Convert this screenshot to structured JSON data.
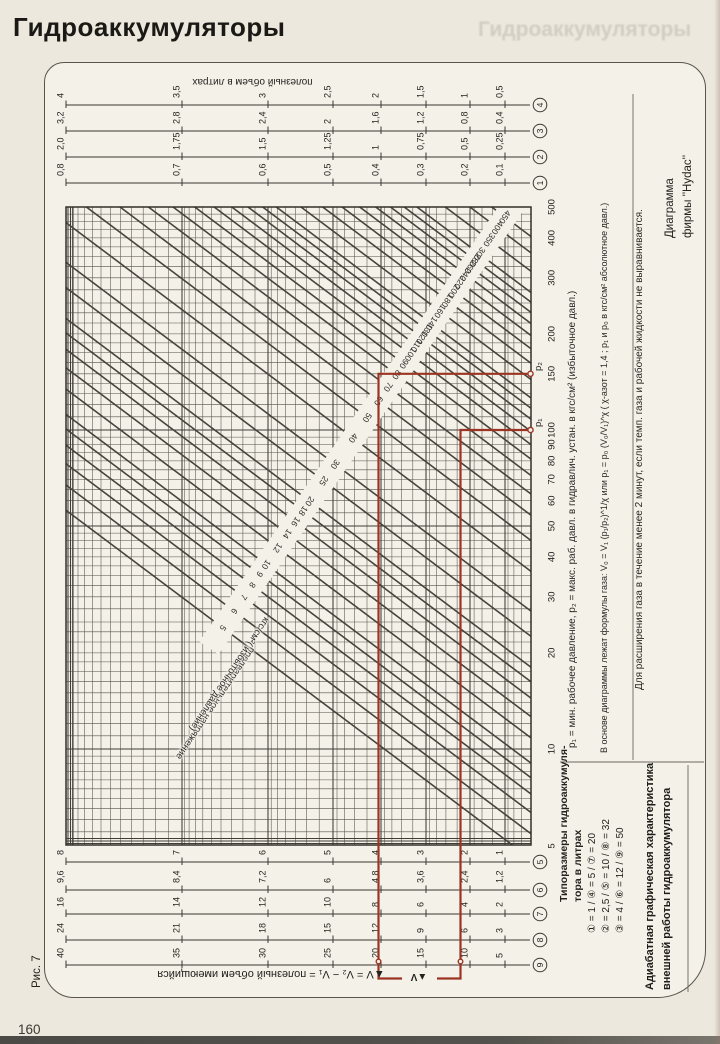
{
  "page": {
    "title": "Гидроаккумуляторы",
    "ghost_title": "Гидроаккумуляторы",
    "page_number": "160",
    "figure_label": "Рис. 7"
  },
  "diagram": {
    "credit": {
      "line1": "Диаграмма",
      "line2": "фирмы ''Hydac''"
    },
    "top_caption": "полезный объем в литрах",
    "bottom_caption": "▲V = V₂ − V₁ = полезный объем имеющийся",
    "delta_v_label": "▲V",
    "band_caption": {
      "line1": "предварительное напряжение",
      "line2": "кгс/см²( избыточное давление)"
    },
    "notes": [
      "p₁ = мин. рабочее давление,  p₂ = макс. раб. давл. в гидравлич. устан. в кгс/см²  (избыточное давл.)",
      "В основе диаграммы лежат формулы газа:  V₀ = V₁ (p₁/p₂)^1/χ  или  p₁ = p₀ (V₀/V₁)^χ   ( χ-азот = 1,4 ;  p₁ и p₀ в кгс/см² абсолютное давл.)",
      "Для расширения газа в течение менее 2 минут, если темп. газа и рабочей жидкости не выравнивается."
    ],
    "sizes": {
      "title_line1": "Типоразмеры гидроаккумуля-",
      "title_line2": "тора в литрах",
      "rows": [
        "① = 1   / ④ = 5  / ⑦ = 20",
        "② = 2,5 / ⑤ = 10 / ⑧ = 32",
        "③ = 4   / ⑥ = 12 / ⑨ = 50"
      ]
    },
    "caption_title": {
      "line1": "Адиабатная графическая характеристика",
      "line2": "внешней работы гидроаккумулятора"
    },
    "red_overlay": {
      "p1_label": "p₁",
      "p2_label": "p₂",
      "p1_value": 100,
      "p2_value": 150,
      "color": "#9c3424"
    },
    "pressure_axis_values": [
      500,
      400,
      300,
      200,
      150,
      100,
      90,
      80,
      70,
      60,
      50,
      40,
      30,
      20,
      10,
      5
    ],
    "precharge_values": [
      5,
      6,
      7,
      8,
      9,
      10,
      12,
      14,
      16,
      18,
      20,
      25,
      30,
      40,
      50,
      60,
      70,
      80,
      90,
      100,
      110,
      120,
      130,
      140,
      160,
      180,
      200,
      220,
      240,
      260,
      280,
      300,
      350,
      400,
      450
    ],
    "top_scales": [
      {
        "id": "4",
        "labels": [
          "4",
          "3,5",
          "3",
          "2,5",
          "2",
          "1,5",
          "1",
          "0,5"
        ]
      },
      {
        "id": "3",
        "labels": [
          "3,2",
          "2,8",
          "2,4",
          "2",
          "1,6",
          "1,2",
          "0,8",
          "0,4"
        ]
      },
      {
        "id": "2",
        "labels": [
          "2,0",
          "1,75",
          "1,5",
          "1,25",
          "1",
          "0,75",
          "0,5",
          "0,25"
        ]
      },
      {
        "id": "1",
        "labels": [
          "0,8",
          "0,7",
          "0,6",
          "0,5",
          "0,4",
          "0,3",
          "0,2",
          "0,1"
        ]
      }
    ],
    "bottom_scales": [
      {
        "id": "5",
        "labels": [
          "8",
          "7",
          "6",
          "5",
          "4",
          "3",
          "2",
          "1"
        ]
      },
      {
        "id": "6",
        "labels": [
          "9,6",
          "8,4",
          "7,2",
          "6",
          "4,8",
          "3,6",
          "2,4",
          "1,2"
        ]
      },
      {
        "id": "7",
        "labels": [
          "16",
          "14",
          "12",
          "10",
          "8",
          "6",
          "4",
          "2"
        ]
      },
      {
        "id": "8",
        "labels": [
          "24",
          "21",
          "18",
          "15",
          "12",
          "9",
          "6",
          "3"
        ]
      },
      {
        "id": "9",
        "labels": [
          "40",
          "35",
          "30",
          "25",
          "20",
          "15",
          "10",
          "5"
        ]
      }
    ]
  },
  "chart_data": {
    "type": "line",
    "title": "Адиабатная графическая характеристика внешней работы гидроаккумулятора (Диаграмма фирмы Hydac)",
    "x_axis": {
      "label": "давление, кгс/см²",
      "scale": "log",
      "range": [
        5,
        500
      ],
      "ticks": [
        5,
        10,
        20,
        30,
        40,
        50,
        60,
        70,
        80,
        90,
        100,
        150,
        200,
        300,
        400,
        500
      ]
    },
    "y_axis": {
      "label": "полезный объем в литрах",
      "scale": "log"
    },
    "series_family": "адиабаты для предварительного напряжения, кгс/см² (избыточное давление)",
    "series_values": [
      5,
      6,
      7,
      8,
      9,
      10,
      12,
      14,
      16,
      18,
      20,
      25,
      30,
      40,
      50,
      60,
      70,
      80,
      90,
      100,
      110,
      120,
      130,
      140,
      160,
      180,
      200,
      220,
      240,
      260,
      280,
      300,
      350,
      400,
      450
    ],
    "accumulator_sizes_litres": {
      "1": 1,
      "2": 2.5,
      "3": 4,
      "4": 5,
      "5": 10,
      "6": 12,
      "7": 20,
      "8": 32,
      "9": 50
    },
    "worked_example": {
      "p1": 100,
      "p2": 150,
      "result": "▲V = V₂ − V₁"
    }
  }
}
